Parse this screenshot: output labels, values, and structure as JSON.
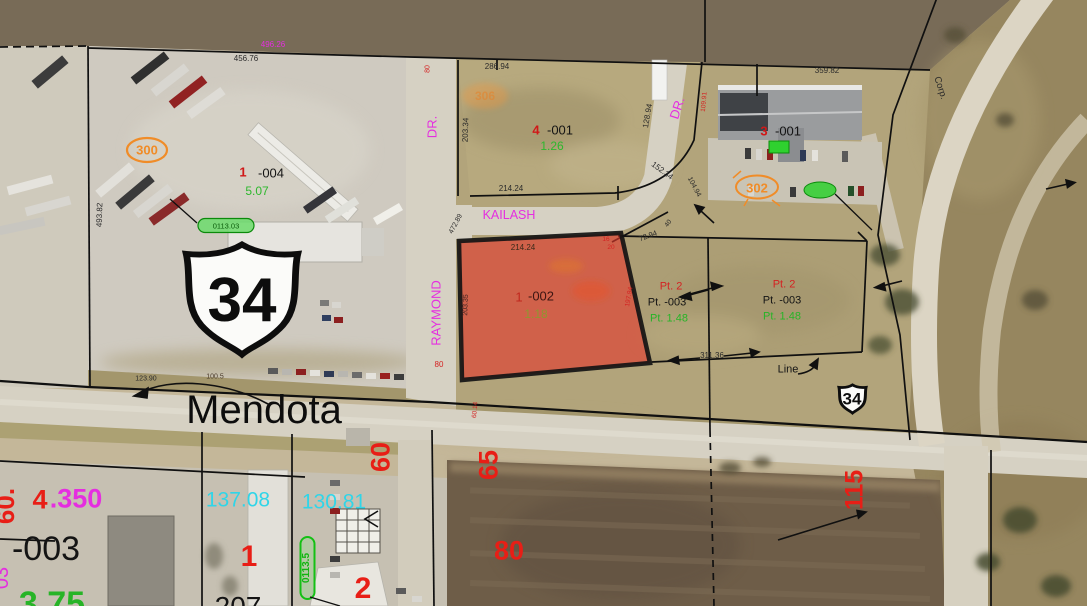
{
  "view": {
    "description": "County GIS parcel map over winter aerial photo",
    "width_px": 1087,
    "height_px": 606
  },
  "selected_parcel": {
    "parcel_number": "1 -002",
    "acreage": "1.18",
    "frontage_top": "214.24",
    "side_left": "203.35",
    "highlight_color": "#e2392b"
  },
  "colors": {
    "street_label_magenta": "#e52ee0",
    "acreage_green": "#2db82d",
    "dimension_black": "#2a2a2a",
    "parcel_prefix_red": "#d01818",
    "annotation_red_large": "#e81e16",
    "site_marker_orange": "#f08c28",
    "address_pill_green": "#17c417",
    "cyan_dimension": "#30d5e8"
  },
  "labels": [
    {
      "n": "dim-456-76",
      "t": "456.76",
      "x": 246,
      "y": 59,
      "s": 8,
      "c": "#2a2a2a"
    },
    {
      "n": "dim-496-26",
      "t": "496.26",
      "x": 273,
      "y": 45,
      "s": 8,
      "c": "#e52ee0"
    },
    {
      "n": "site-marker-300",
      "t": "300",
      "x": 147,
      "y": 150,
      "s": 13,
      "c": "#f08c28",
      "b": 1
    },
    {
      "n": "parcel-prefix-1-004",
      "t": "1",
      "x": 243,
      "y": 172,
      "s": 13,
      "c": "#d01818",
      "b": 1
    },
    {
      "n": "parcel-number-004",
      "t": "-004",
      "x": 271,
      "y": 173,
      "s": 13,
      "c": "#141414"
    },
    {
      "n": "acreage-5-07",
      "t": "5.07",
      "x": 257,
      "y": 191,
      "s": 12,
      "c": "#2db82d"
    },
    {
      "n": "dim-493-82",
      "t": "493.82",
      "x": 100,
      "y": 215,
      "s": 8,
      "c": "#2a2a2a",
      "r": -88
    },
    {
      "n": "address-pill-0113-03",
      "t": "0113.03",
      "x": 226,
      "y": 226,
      "s": 7.5,
      "c": "#0a5c0a"
    },
    {
      "n": "dim-123-90",
      "t": "123.90",
      "x": 146,
      "y": 379,
      "s": 7,
      "c": "#2a2a2a"
    },
    {
      "n": "dim-100-5",
      "t": "100.5",
      "x": 215,
      "y": 377,
      "s": 7,
      "c": "#4a3a2a"
    },
    {
      "n": "street-name-mendota",
      "t": "Mendota",
      "x": 264,
      "y": 410,
      "s": 40,
      "c": "#0d0d0d"
    },
    {
      "n": "dim-80-raymond-top",
      "t": "80",
      "x": 428,
      "y": 69,
      "s": 7,
      "c": "#d42222",
      "r": -90
    },
    {
      "n": "street-raymond-dr-suffix",
      "t": "DR.",
      "x": 432,
      "y": 127,
      "s": 13,
      "c": "#e52ee0",
      "r": -90
    },
    {
      "n": "street-raymond",
      "t": "RAYMOND",
      "x": 436,
      "y": 313,
      "s": 13,
      "c": "#e52ee0",
      "r": -90
    },
    {
      "n": "dim-203-34",
      "t": "203.34",
      "x": 466,
      "y": 130,
      "s": 8,
      "c": "#2a2a2a",
      "r": -88
    },
    {
      "n": "dim-286-94",
      "t": "286.94",
      "x": 497,
      "y": 67,
      "s": 8,
      "c": "#2a2a2a"
    },
    {
      "n": "site-marker-306",
      "t": "306",
      "x": 485,
      "y": 96,
      "s": 12,
      "c": "rgba(230,130,40,0.55)",
      "b": 1
    },
    {
      "n": "parcel-prefix-4-001",
      "t": "4",
      "x": 536,
      "y": 130,
      "s": 13,
      "c": "#d01818",
      "b": 1
    },
    {
      "n": "parcel-number-001-mid",
      "t": "-001",
      "x": 560,
      "y": 130,
      "s": 13,
      "c": "#141414"
    },
    {
      "n": "acreage-1-26",
      "t": "1.26",
      "x": 552,
      "y": 146,
      "s": 12,
      "c": "#2db82d"
    },
    {
      "n": "dim-128-94",
      "t": "128.94",
      "x": 648,
      "y": 116,
      "s": 8,
      "c": "#2a2a2a",
      "r": -80
    },
    {
      "n": "dim-109-91",
      "t": "109.91",
      "x": 705,
      "y": 102,
      "s": 6.5,
      "c": "#d42222",
      "r": -85
    },
    {
      "n": "street-dr-east",
      "t": "DR.",
      "x": 677,
      "y": 108,
      "s": 13,
      "c": "#e52ee0",
      "r": -72
    },
    {
      "n": "dim-152-34",
      "t": "152.34",
      "x": 662,
      "y": 171,
      "s": 8,
      "c": "#2a2a2a",
      "r": 36
    },
    {
      "n": "dim-104-94",
      "t": "104.94",
      "x": 694,
      "y": 187,
      "s": 7,
      "c": "#2a2a2a",
      "r": 62
    },
    {
      "n": "dim-214-24-mid",
      "t": "214.24",
      "x": 511,
      "y": 189,
      "s": 8,
      "c": "#2a2a2a"
    },
    {
      "n": "street-kailash",
      "t": "KAILASH",
      "x": 509,
      "y": 215,
      "s": 12.5,
      "c": "#e52ee0"
    },
    {
      "n": "dim-472-89",
      "t": "472.89",
      "x": 456,
      "y": 224,
      "s": 7,
      "c": "#2a2a2a",
      "r": -62
    },
    {
      "n": "dim-359-82",
      "t": "359.82",
      "x": 827,
      "y": 71,
      "s": 8,
      "c": "#2a2a2a"
    },
    {
      "n": "parcel-prefix-3-001",
      "t": "3",
      "x": 764,
      "y": 131,
      "s": 13,
      "c": "#d01818",
      "b": 1
    },
    {
      "n": "parcel-number-001-right",
      "t": "-001",
      "x": 788,
      "y": 131,
      "s": 13,
      "c": "#141414"
    },
    {
      "n": "site-marker-302",
      "t": "302",
      "x": 757,
      "y": 188,
      "s": 13,
      "c": "#f08c28",
      "b": 1
    },
    {
      "n": "label-corp",
      "t": "Corp.",
      "x": 940,
      "y": 88,
      "s": 9.5,
      "c": "#2a2a2a",
      "r": 72
    },
    {
      "n": "dim-214-24-selected",
      "t": "214.24",
      "x": 523,
      "y": 248,
      "s": 8,
      "c": "#3a2a1a"
    },
    {
      "n": "dim-16",
      "t": "16",
      "x": 606,
      "y": 240,
      "s": 6.5,
      "c": "#d42222"
    },
    {
      "n": "dim-20",
      "t": "20",
      "x": 611,
      "y": 248,
      "s": 6.5,
      "c": "#d42222"
    },
    {
      "n": "dim-72-94",
      "t": "72.94",
      "x": 648,
      "y": 236,
      "s": 7.5,
      "c": "#2a2a2a",
      "r": -20
    },
    {
      "n": "dim-40",
      "t": "40",
      "x": 669,
      "y": 224,
      "s": 6.5,
      "c": "#2a2a2a",
      "r": -55
    },
    {
      "n": "dim-203-35",
      "t": "203.35",
      "x": 466,
      "y": 305,
      "s": 7,
      "c": "#3a2020",
      "r": -88
    },
    {
      "n": "parcel-prefix-1-002",
      "t": "1",
      "x": 519,
      "y": 297,
      "s": 13,
      "c": "#c0281e"
    },
    {
      "n": "parcel-number-002",
      "t": "-002",
      "x": 541,
      "y": 296,
      "s": 13,
      "c": "#3d1512"
    },
    {
      "n": "acreage-1-18",
      "t": "1.18",
      "x": 536,
      "y": 314,
      "s": 12,
      "c": "#8f9630"
    },
    {
      "n": "dim-197-94",
      "t": "197.94",
      "x": 630,
      "y": 297,
      "s": 6.5,
      "c": "#d42222",
      "r": -80
    },
    {
      "n": "label-pt2-west",
      "t": "Pt. 2",
      "x": 671,
      "y": 287,
      "s": 11,
      "c": "#d42222"
    },
    {
      "n": "label-pt-003-west",
      "t": "Pt. -003",
      "x": 667,
      "y": 303,
      "s": 11,
      "c": "#141414"
    },
    {
      "n": "label-pt-1-48-west",
      "t": "Pt. 1.48",
      "x": 669,
      "y": 319,
      "s": 11,
      "c": "#27b427"
    },
    {
      "n": "label-pt2-east",
      "t": "Pt. 2",
      "x": 784,
      "y": 285,
      "s": 11,
      "c": "#d42222"
    },
    {
      "n": "label-pt-003-east",
      "t": "Pt. -003",
      "x": 782,
      "y": 301,
      "s": 11,
      "c": "#141414"
    },
    {
      "n": "label-pt-1-48-east",
      "t": "Pt. 1.48",
      "x": 782,
      "y": 317,
      "s": 11,
      "c": "#27b427"
    },
    {
      "n": "dim-311-36",
      "t": "311.36",
      "x": 712,
      "y": 356,
      "s": 8,
      "c": "#2a2a2a"
    },
    {
      "n": "label-line",
      "t": "Line",
      "x": 788,
      "y": 370,
      "s": 11,
      "c": "#141414"
    },
    {
      "n": "us34-shield-large-number",
      "t": "34",
      "x": 242,
      "y": 301,
      "s": 62,
      "c": "#0d0d0d",
      "b": 1
    },
    {
      "n": "us34-shield-small-number",
      "t": "34",
      "x": 852,
      "y": 399,
      "s": 17,
      "c": "#0d0d0d",
      "b": 1
    },
    {
      "n": "dim-80-raymond-south",
      "t": "80",
      "x": 439,
      "y": 365,
      "s": 8,
      "c": "#d42222"
    },
    {
      "n": "dim-60-14",
      "t": "60.14",
      "x": 476,
      "y": 410,
      "s": 6.5,
      "c": "#d42222",
      "r": -85
    },
    {
      "n": "lot-dim-60",
      "t": "60",
      "x": 381,
      "y": 457,
      "s": 27,
      "c": "#e81e16",
      "r": -90,
      "b": 1
    },
    {
      "n": "lot-dim-65",
      "t": "65",
      "x": 489,
      "y": 465,
      "s": 27,
      "c": "#e81e16",
      "r": -90,
      "b": 1
    },
    {
      "n": "lot-dim-80",
      "t": "80",
      "x": 509,
      "y": 551,
      "s": 27,
      "c": "#e81e16",
      "b": 1
    },
    {
      "n": "lot-dim-115",
      "t": "115",
      "x": 855,
      "y": 490,
      "s": 25,
      "c": "#e81e16",
      "r": -90,
      "b": 1
    },
    {
      "n": "lot-dim-60-left",
      "t": "60.",
      "x": 5,
      "y": 506,
      "s": 26,
      "c": "#e81e16",
      "r": -90,
      "b": 1
    },
    {
      "n": "parcel-prefix-4-350",
      "t": "4",
      "x": 40,
      "y": 500,
      "s": 27,
      "c": "#e81e16",
      "b": 1
    },
    {
      "n": "parcel-suffix-350",
      "t": ".350",
      "x": 76,
      "y": 499,
      "s": 27,
      "c": "#e52ee0",
      "b": 1
    },
    {
      "n": "parcel-number-003-sw",
      "t": "-003",
      "x": 46,
      "y": 549,
      "s": 34,
      "c": "#141414"
    },
    {
      "n": "dim-137-08",
      "t": "137.08",
      "x": 238,
      "y": 500,
      "s": 21,
      "c": "#30d5e8"
    },
    {
      "n": "dim-130-81",
      "t": "130.81",
      "x": 334,
      "y": 502,
      "s": 21,
      "c": "#30d5e8"
    },
    {
      "n": "lot-number-1-sw",
      "t": "1",
      "x": 249,
      "y": 557,
      "s": 30,
      "c": "#e81e16",
      "b": 1
    },
    {
      "n": "lot-number-2-sw",
      "t": "2",
      "x": 363,
      "y": 589,
      "s": 30,
      "c": "#e81e16",
      "b": 1
    },
    {
      "n": "parcel-number-207-clipped",
      "t": "207",
      "x": 238,
      "y": 607,
      "s": 28,
      "c": "#141414"
    },
    {
      "n": "acreage-3-75-clipped",
      "t": "3.75",
      "x": 52,
      "y": 604,
      "s": 34,
      "c": "#27b427",
      "b": 1
    },
    {
      "n": "dim-03-clipped",
      "t": "03",
      "x": 2,
      "y": 578,
      "s": 20,
      "c": "#e52ee0",
      "r": -90
    },
    {
      "n": "address-pill-0113-5",
      "t": "0113.5",
      "x": 307,
      "y": 568,
      "s": 10,
      "c": "#12b412",
      "r": -90,
      "b": 1
    }
  ]
}
